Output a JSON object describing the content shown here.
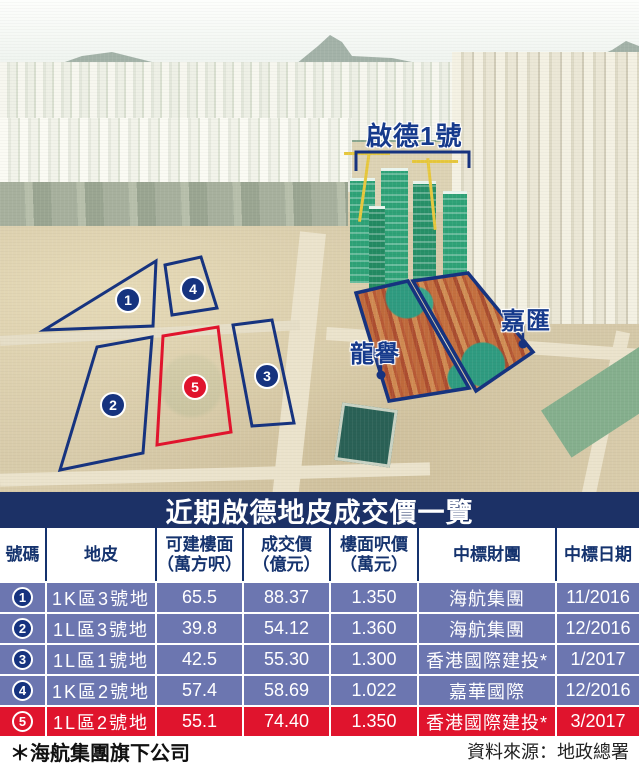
{
  "photo": {
    "labels": {
      "kai_tak_1": "啟德1號",
      "lung_yue": "龍譽",
      "ka_wai": "嘉匯"
    },
    "markers": [
      "1",
      "2",
      "3",
      "4",
      "5"
    ]
  },
  "table": {
    "title": "近期啟德地皮成交價一覽",
    "columns": [
      {
        "label": "號碼",
        "sub": ""
      },
      {
        "label": "地皮",
        "sub": ""
      },
      {
        "label": "可建樓面",
        "sub": "（萬方呎）"
      },
      {
        "label": "成交價",
        "sub": "（億元）"
      },
      {
        "label": "樓面呎價",
        "sub": "（萬元）"
      },
      {
        "label": "中標財團",
        "sub": ""
      },
      {
        "label": "中標日期",
        "sub": ""
      }
    ],
    "rows": [
      {
        "no": "1",
        "site": "1K區3號地",
        "area": "65.5",
        "price": "88.37",
        "unit_price": "1.350",
        "winner": "海航集團",
        "date": "11/2016"
      },
      {
        "no": "2",
        "site": "1L區3號地",
        "area": "39.8",
        "price": "54.12",
        "unit_price": "1.360",
        "winner": "海航集團",
        "date": "12/2016"
      },
      {
        "no": "3",
        "site": "1L區1號地",
        "area": "42.5",
        "price": "55.30",
        "unit_price": "1.300",
        "winner": "香港國際建投*",
        "date": "1/2017"
      },
      {
        "no": "4",
        "site": "1K區2號地",
        "area": "57.4",
        "price": "58.69",
        "unit_price": "1.022",
        "winner": "嘉華國際",
        "date": "12/2016"
      },
      {
        "no": "5",
        "site": "1L區2號地",
        "area": "55.1",
        "price": "74.40",
        "unit_price": "1.350",
        "winner": "香港國際建投*",
        "date": "3/2017"
      }
    ]
  },
  "footer": {
    "note": "＊海航集團旗下公司",
    "source": "資料來源：地政總署"
  },
  "colors": {
    "navy": "#1c3166",
    "row_blue": "#6c76b0",
    "highlight_red": "#e0142d",
    "outline_blue": "#16337f"
  }
}
